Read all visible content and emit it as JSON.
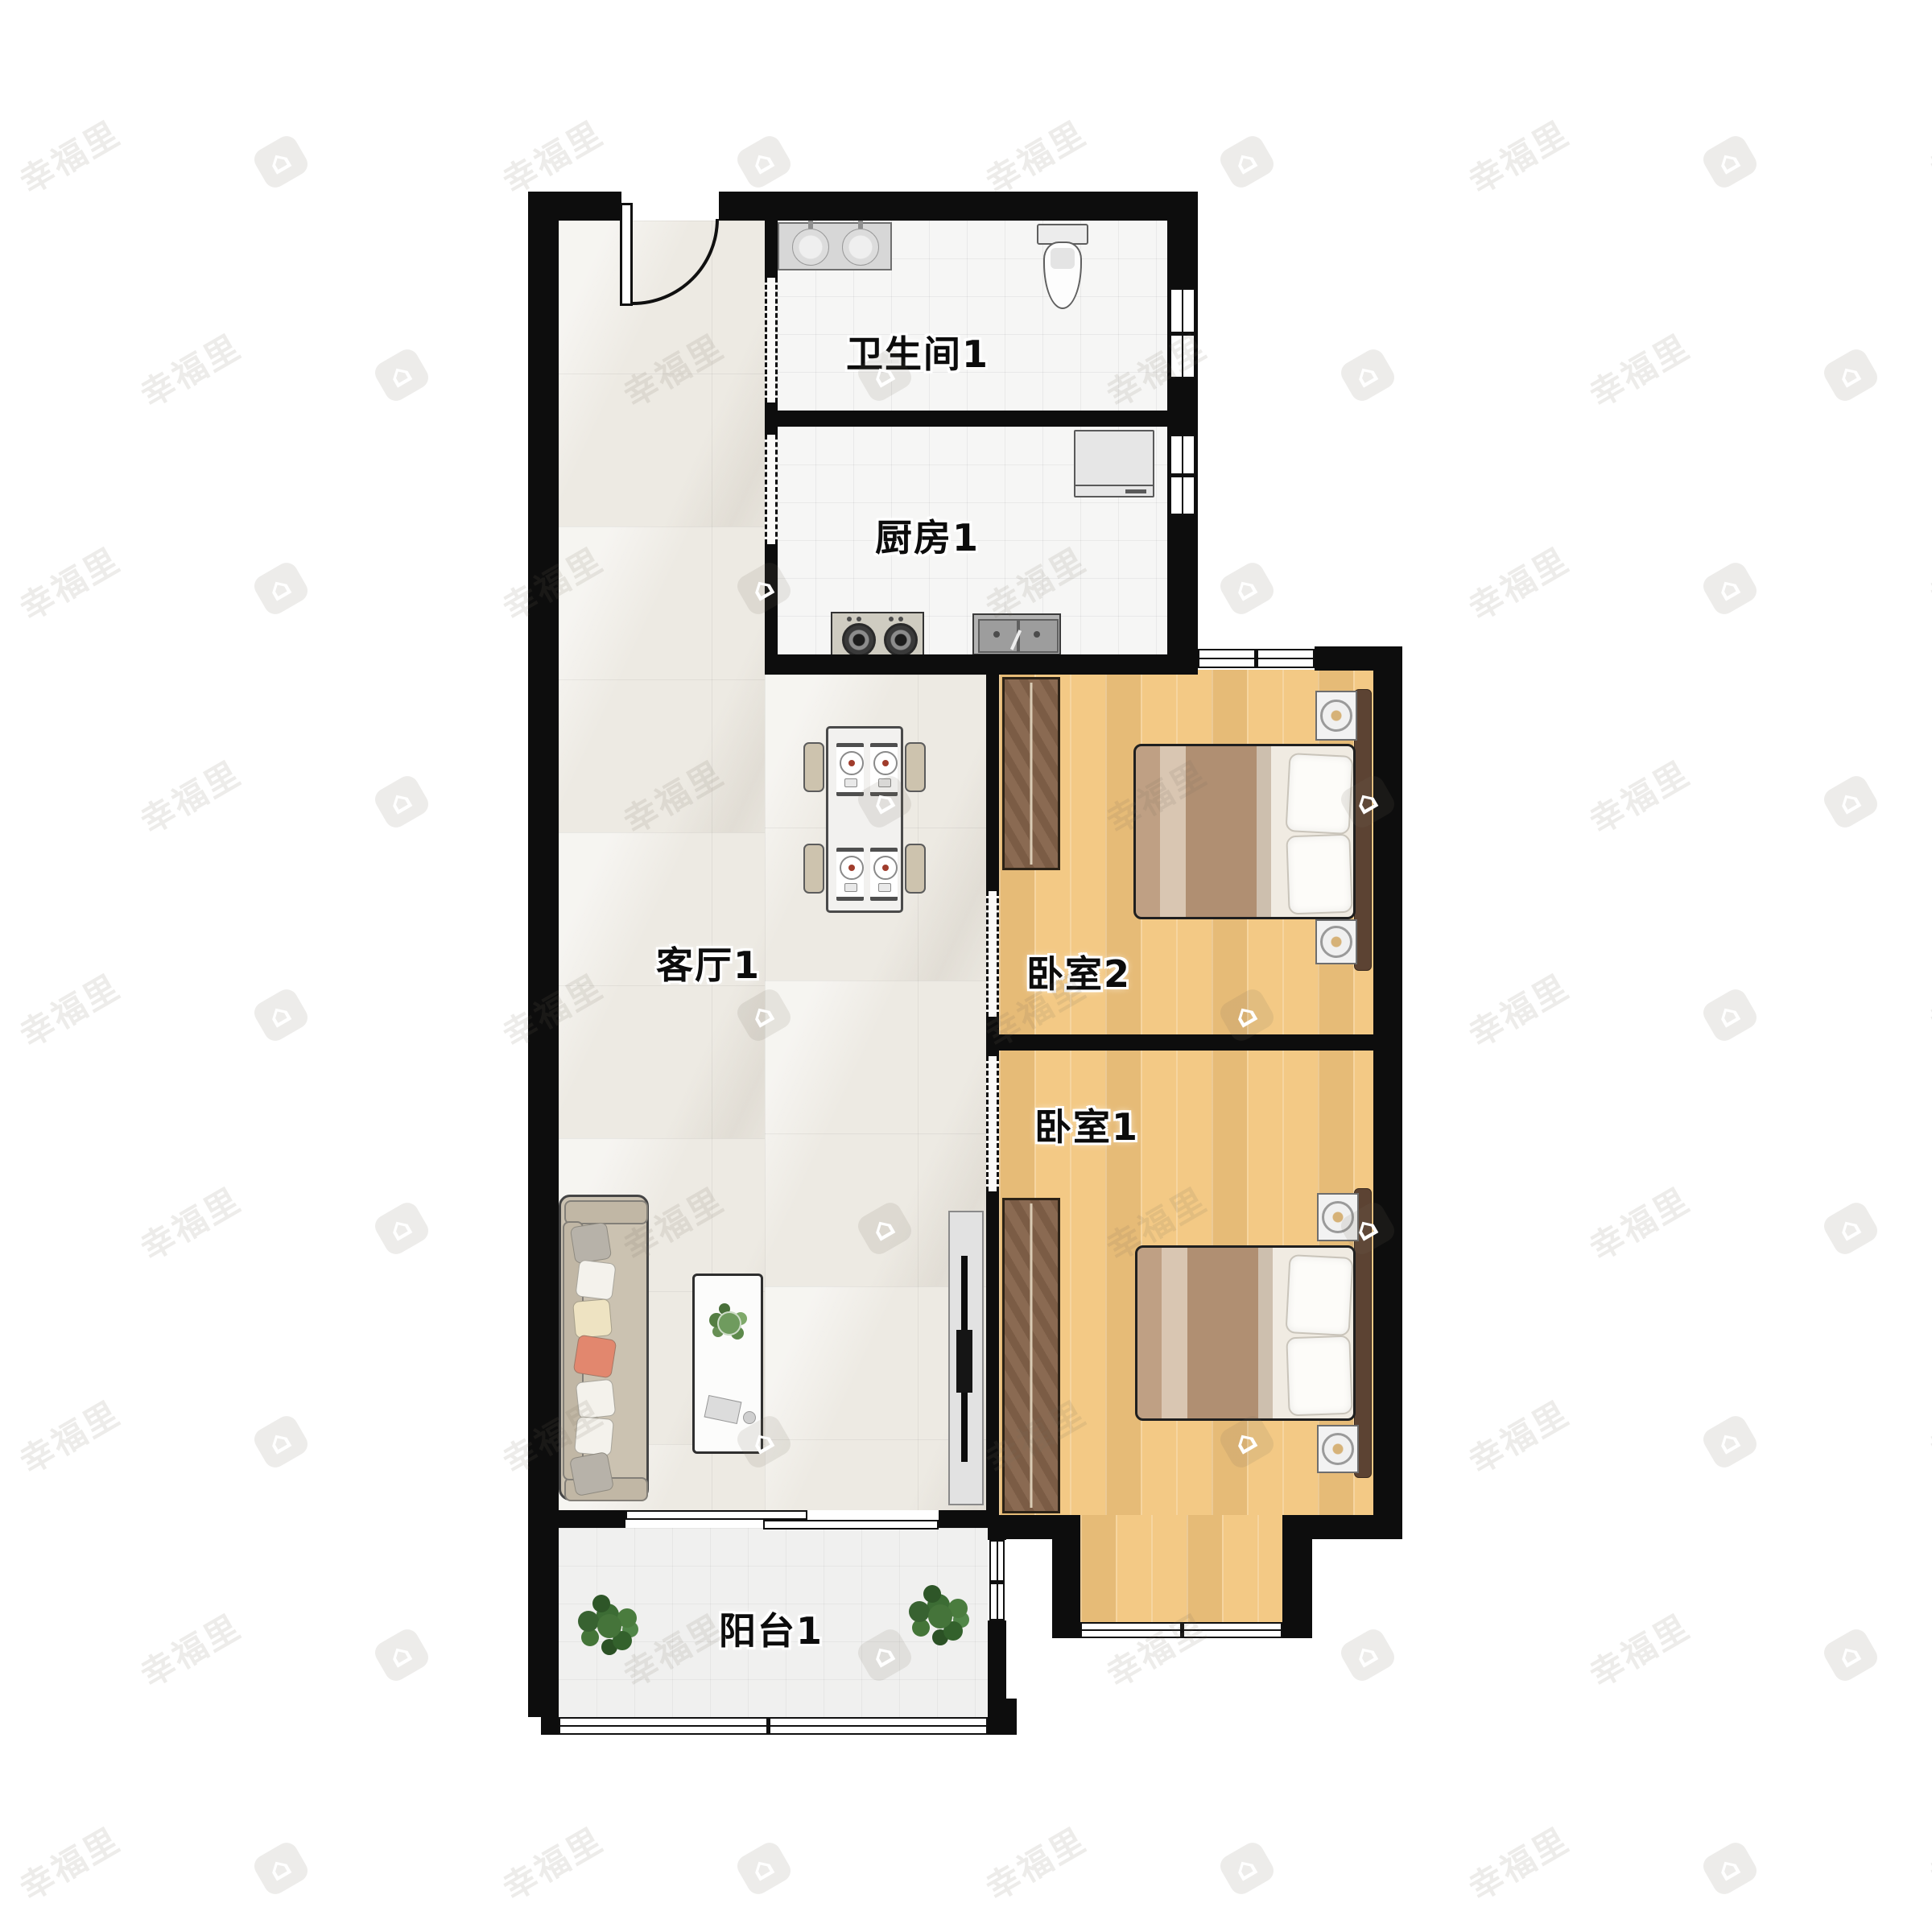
{
  "plan": {
    "type": "apartment-floor-plan",
    "watermark": {
      "text": "幸福里",
      "icon": "house-logo-icon"
    },
    "rooms": [
      {
        "id": "bathroom",
        "label": "卫生间1"
      },
      {
        "id": "kitchen",
        "label": "厨房1"
      },
      {
        "id": "living-room",
        "label": "客厅1"
      },
      {
        "id": "bedroom-2",
        "label": "卧室2"
      },
      {
        "id": "bedroom-1",
        "label": "卧室1"
      },
      {
        "id": "balcony",
        "label": "阳台1"
      }
    ],
    "colors": {
      "wall": "#0d0d0d",
      "living_floor": "#edeae3",
      "wet_room_floor": "#f6f6f5",
      "bedroom_floor": "#f3c985",
      "balcony_floor": "#f0f0ef",
      "wardrobe": "#82624a",
      "bed_blanket": "#c4a78b",
      "accent_pillow": "#e2876e",
      "plant": "#45743a",
      "watermark_tint": "rgba(118,106,95,0.13)"
    }
  }
}
